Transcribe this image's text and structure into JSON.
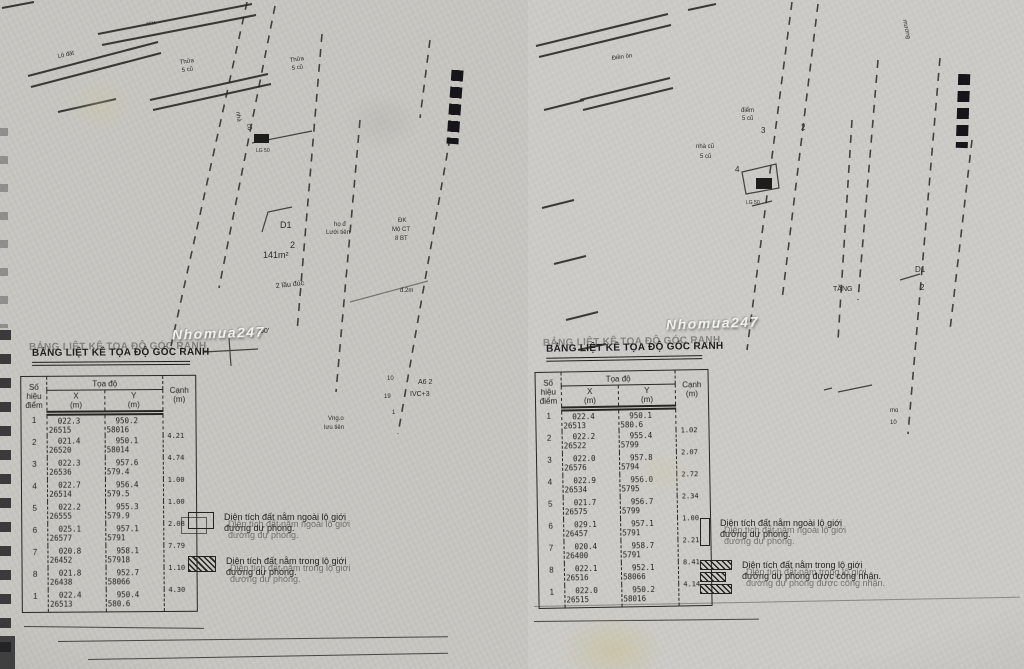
{
  "watermark": {
    "text": "Nhomua247"
  },
  "pages": {
    "left": {
      "table_title": "BẢNG LIỆT KÊ TỌA ĐỘ GÓC RANH",
      "table": {
        "headers": {
          "point1": "Số hiệu",
          "point2": "điểm",
          "coord": "Tọa độ",
          "x1": "X",
          "x2": "(m)",
          "y1": "Y",
          "y2": "(m)",
          "edge1": "Cạnh",
          "edge2": "(m)"
        },
        "rows": [
          {
            "n": "1",
            "x1": "022.3",
            "x2": "26515",
            "y1": "950.2",
            "y2": "58016",
            "c": ""
          },
          {
            "n": "2",
            "x1": "021.4",
            "x2": "26520",
            "y1": "950.1",
            "y2": "58014",
            "c": "4.21"
          },
          {
            "n": "3",
            "x1": "022.3",
            "x2": "26536",
            "y1": "957.6",
            "y2": "579.4",
            "c": "4.74"
          },
          {
            "n": "4",
            "x1": "022.7",
            "x2": "26514",
            "y1": "956.4",
            "y2": "579.5",
            "c": "1.00"
          },
          {
            "n": "5",
            "x1": "022.2",
            "x2": "26555",
            "y1": "955.3",
            "y2": "579.9",
            "c": "1.00"
          },
          {
            "n": "6",
            "x1": "025.1",
            "x2": "26577",
            "y1": "957.1",
            "y2": "5791",
            "c": "2.08"
          },
          {
            "n": "7",
            "x1": "020.8",
            "x2": "26452",
            "y1": "958.1",
            "y2": "57918",
            "c": "7.79"
          },
          {
            "n": "8",
            "x1": "021.8",
            "x2": "26438",
            "y1": "952.7",
            "y2": "58066",
            "c": "1.10"
          },
          {
            "n": "1",
            "x1": "022.4",
            "x2": "26513",
            "y1": "950.4",
            "y2": "580.6",
            "c": "4.30"
          }
        ]
      },
      "legend": [
        {
          "swatch": "outline-swatch",
          "line1": "Diện tích đất nằm ngoài lộ giới",
          "line2": "đường dự phóng."
        },
        {
          "swatch": "hatched-swatch",
          "line1": "Diện tích đất nằm trong lộ giới",
          "line2": "đường dự phóng."
        }
      ],
      "labels": [
        {
          "t": "ATM",
          "x": 146,
          "y": 26,
          "s": 5,
          "r": -10
        },
        {
          "t": "Lộ đất",
          "x": 58,
          "y": 58,
          "s": 6,
          "r": -12
        },
        {
          "t": "Thửa",
          "x": 180,
          "y": 64,
          "s": 6,
          "r": -8
        },
        {
          "t": "5 cũ",
          "x": 182,
          "y": 72,
          "s": 6,
          "r": -8
        },
        {
          "t": "Thửa",
          "x": 290,
          "y": 62,
          "s": 6,
          "r": -8
        },
        {
          "t": "5 cũ",
          "x": 292,
          "y": 70,
          "s": 6,
          "r": -8
        },
        {
          "t": "nhà",
          "x": 236,
          "y": 112,
          "s": 6,
          "r": 80
        },
        {
          "t": "cũ",
          "x": 247,
          "y": 124,
          "s": 6,
          "r": 80
        },
        {
          "t": "LG 50",
          "x": 256,
          "y": 152,
          "s": 5
        },
        {
          "t": "D1",
          "x": 280,
          "y": 228,
          "s": 9
        },
        {
          "t": "2",
          "x": 290,
          "y": 248,
          "s": 9
        },
        {
          "t": "141m²",
          "x": 263,
          "y": 258,
          "s": 9
        },
        {
          "t": "2 lầu đúc",
          "x": 276,
          "y": 288,
          "s": 7,
          "r": -6
        },
        {
          "t": "họ đ",
          "x": 334,
          "y": 226,
          "s": 6
        },
        {
          "t": "Lưới tiên",
          "x": 326,
          "y": 234,
          "s": 6
        },
        {
          "t": "ĐK",
          "x": 398,
          "y": 222,
          "s": 6
        },
        {
          "t": "Mộ CT",
          "x": 392,
          "y": 231,
          "s": 6
        },
        {
          "t": "8 BT",
          "x": 395,
          "y": 240,
          "s": 6
        },
        {
          "t": "đ.2m",
          "x": 400,
          "y": 292,
          "s": 6
        },
        {
          "t": "60'",
          "x": 260,
          "y": 333,
          "s": 7
        },
        {
          "t": "Vng.o",
          "x": 328,
          "y": 420,
          "s": 6
        },
        {
          "t": "lưu tiên",
          "x": 324,
          "y": 429,
          "s": 6
        },
        {
          "t": "A6 2",
          "x": 418,
          "y": 384,
          "s": 7
        },
        {
          "t": "IVC+3",
          "x": 410,
          "y": 396,
          "s": 7
        },
        {
          "t": "10",
          "x": 387,
          "y": 380,
          "s": 6
        },
        {
          "t": "19",
          "x": 384,
          "y": 398,
          "s": 6
        },
        {
          "t": "1",
          "x": 392,
          "y": 414,
          "s": 6
        }
      ]
    },
    "right": {
      "table_title": "BẢNG LIỆT KÊ TỌA ĐỘ GÓC RANH",
      "table": {
        "headers": {
          "point1": "Số hiệu",
          "point2": "điểm",
          "coord": "Tọa độ",
          "x1": "X",
          "x2": "(m)",
          "y1": "Y",
          "y2": "(m)",
          "edge1": "Cạnh",
          "edge2": "(m)"
        },
        "rows": [
          {
            "n": "1",
            "x1": "022.4",
            "x2": "26513",
            "y1": "950.1",
            "y2": "580.6",
            "c": ""
          },
          {
            "n": "2",
            "x1": "022.2",
            "x2": "26522",
            "y1": "955.4",
            "y2": "5799",
            "c": "1.02"
          },
          {
            "n": "3",
            "x1": "022.0",
            "x2": "26576",
            "y1": "957.8",
            "y2": "5794",
            "c": "2.07"
          },
          {
            "n": "4",
            "x1": "022.9",
            "x2": "26534",
            "y1": "956.0",
            "y2": "5795",
            "c": "2.72"
          },
          {
            "n": "5",
            "x1": "021.7",
            "x2": "26575",
            "y1": "956.7",
            "y2": "5799",
            "c": "2.34"
          },
          {
            "n": "6",
            "x1": "029.1",
            "x2": "26457",
            "y1": "957.1",
            "y2": "5791",
            "c": "1.00"
          },
          {
            "n": "7",
            "x1": "020.4",
            "x2": "26400",
            "y1": "958.7",
            "y2": "5791",
            "c": "2.21"
          },
          {
            "n": "8",
            "x1": "022.1",
            "x2": "26516",
            "y1": "952.1",
            "y2": "58066",
            "c": "8.41"
          },
          {
            "n": "1",
            "x1": "022.0",
            "x2": "26515",
            "y1": "950.2",
            "y2": "58016",
            "c": "4.14"
          }
        ]
      },
      "legend": [
        {
          "swatch": "outline-swatch",
          "line1": "Diện tích đất nằm ngoài lộ giới",
          "line2": "đường dự phóng."
        },
        {
          "swatch": "hatched-swatch",
          "line1": "Diện tích đất nằm trong lộ giới",
          "line2": "đường dự phóng được công nhận."
        }
      ],
      "labels": [
        {
          "t": "mương",
          "x": 383,
          "y": 20,
          "s": 6,
          "r": 78
        },
        {
          "t": "Điền ôn",
          "x": 92,
          "y": 60,
          "s": 6,
          "r": -8
        },
        {
          "t": "điểm",
          "x": 221,
          "y": 112,
          "s": 6
        },
        {
          "t": "5 cũ",
          "x": 222,
          "y": 120,
          "s": 6
        },
        {
          "t": "3",
          "x": 241,
          "y": 133,
          "s": 8
        },
        {
          "t": "2",
          "x": 281,
          "y": 130,
          "s": 8
        },
        {
          "t": "4",
          "x": 215,
          "y": 172,
          "s": 8
        },
        {
          "t": "LG 50",
          "x": 226,
          "y": 204,
          "s": 5
        },
        {
          "t": "nhà cũ",
          "x": 176,
          "y": 148,
          "s": 6
        },
        {
          "t": "5 cũ",
          "x": 180,
          "y": 158,
          "s": 6
        },
        {
          "t": "D1",
          "x": 395,
          "y": 272,
          "s": 8
        },
        {
          "t": "2",
          "x": 400,
          "y": 290,
          "s": 8
        },
        {
          "t": "TẦNG",
          "x": 313,
          "y": 291,
          "s": 7
        },
        {
          "t": "mo",
          "x": 370,
          "y": 412,
          "s": 6
        },
        {
          "t": "10",
          "x": 370,
          "y": 424,
          "s": 6
        }
      ]
    }
  }
}
